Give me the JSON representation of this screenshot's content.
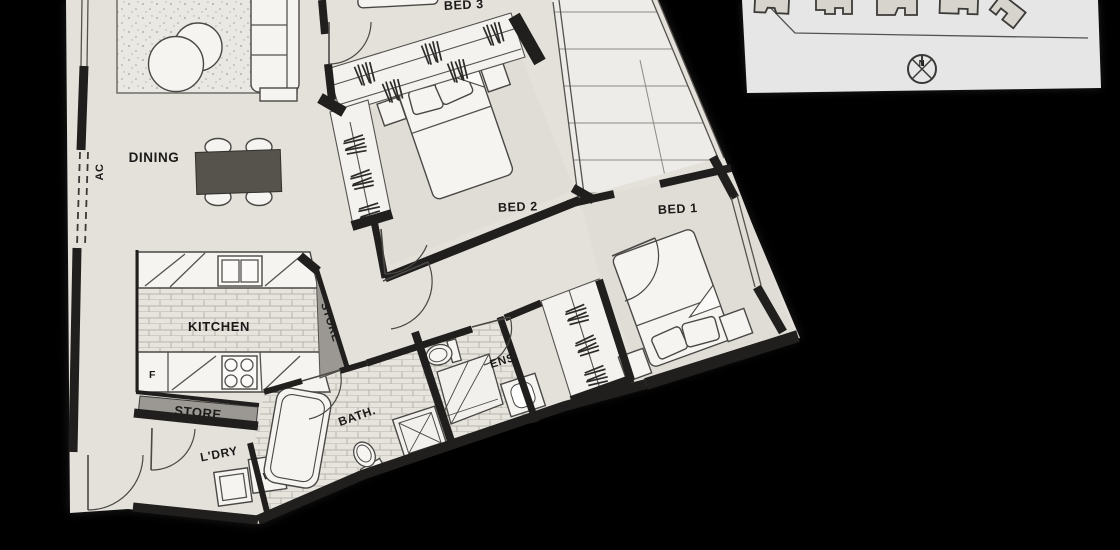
{
  "floor_plan": {
    "rooms": {
      "bed1": "BED 1",
      "bed2": "BED 2",
      "bed3": "BED 3",
      "dining": "DINING",
      "kitchen": "KITCHEN",
      "bath": "BATH.",
      "ensuite": "ENS.",
      "laundry": "L'DRY",
      "store_hall": "STORE",
      "store_closet": "STORE",
      "ac_unit": "AC"
    },
    "appliances": {
      "fridge": "F",
      "washer": "W"
    },
    "site_inset": {
      "compass_north": "N"
    },
    "colors": {
      "background": "#000000",
      "paper": "#e4e1da",
      "balcony": "#edece8",
      "wall": "#201f1d",
      "store_gray": "#9b9894",
      "dining_table": "#56534c"
    }
  }
}
